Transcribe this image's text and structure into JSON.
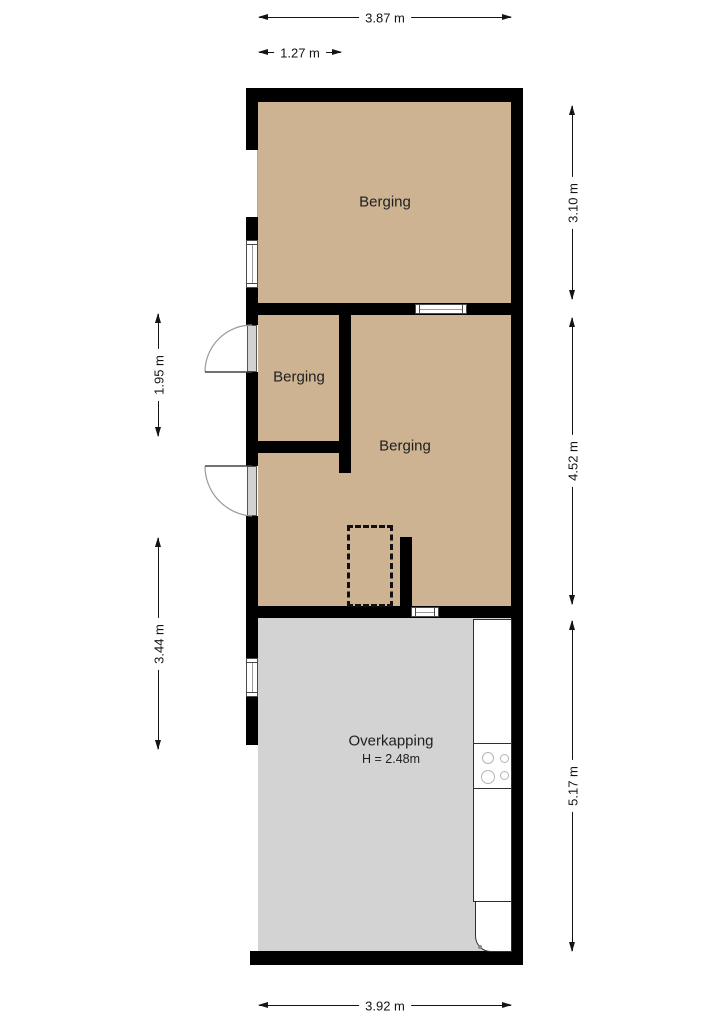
{
  "plan": {
    "rooms": [
      {
        "id": "berging-top",
        "label": "Berging"
      },
      {
        "id": "berging-small",
        "label": "Berging"
      },
      {
        "id": "berging-large",
        "label": "Berging"
      },
      {
        "id": "overkapping",
        "label": "Overkapping",
        "height_note": "H = 2.48m"
      }
    ],
    "dimensions": {
      "top_total": "3.87 m",
      "top_partial": "1.27 m",
      "left_upper": "1.95 m",
      "left_lower": "3.44 m",
      "right_upper": "3.10 m",
      "right_middle": "4.52 m",
      "right_lower": "5.17 m",
      "bottom_total": "3.92 m"
    },
    "colors": {
      "room_fill": "#cdb392",
      "canopy_fill": "#d3d3d3",
      "wall": "#000000",
      "dimension_text": "#141414",
      "window_line": "#9a9a9a"
    }
  }
}
